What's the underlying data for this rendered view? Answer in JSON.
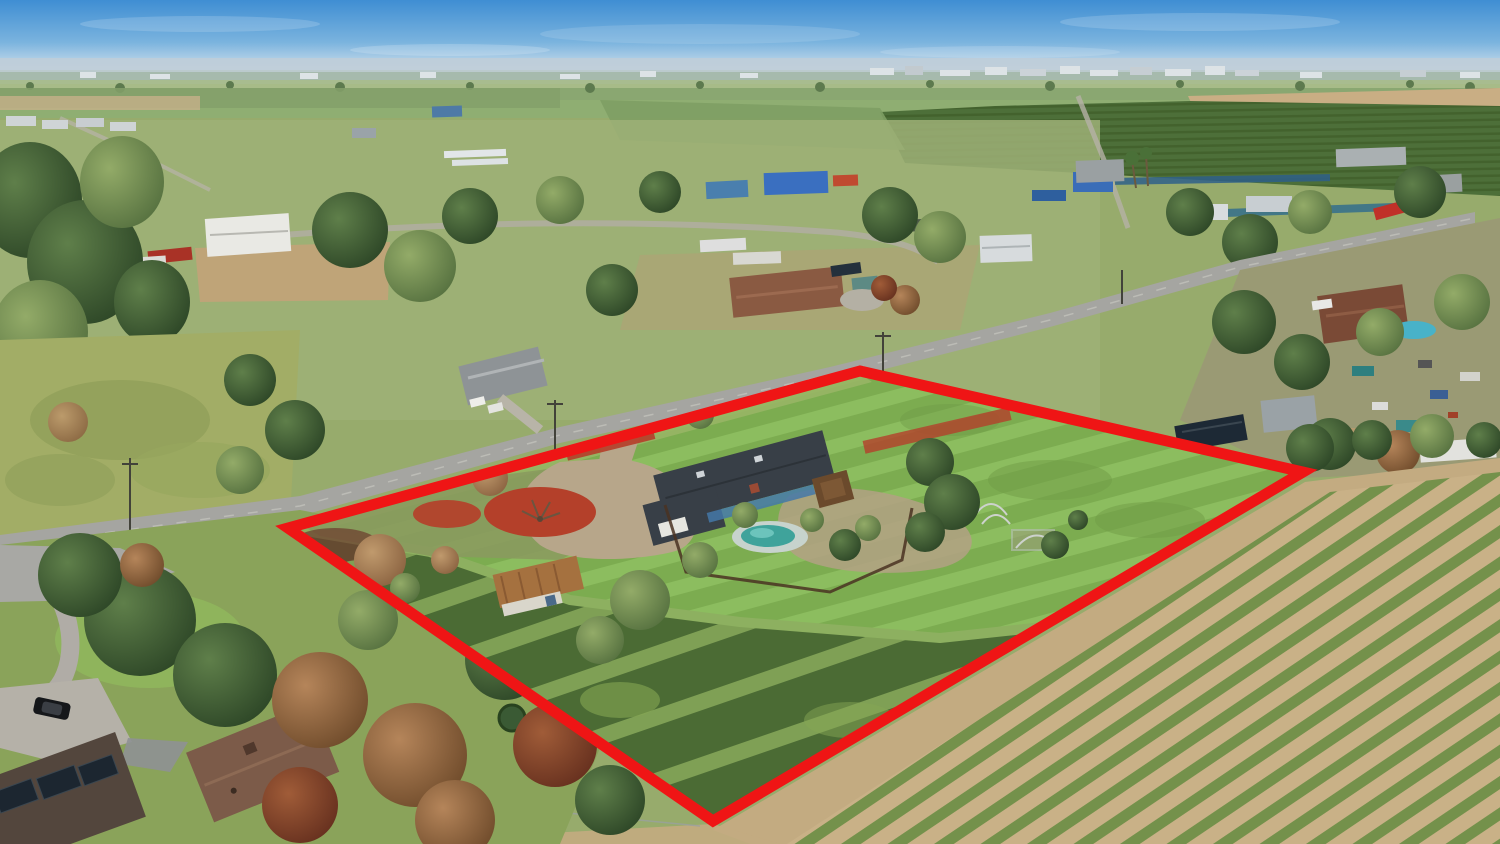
{
  "image": {
    "kind": "aerial-drone-photograph",
    "description": "Aerial view of a rural residential parcel outlined in red, with a ranch house, pool, shed, large mowed lawn and overgrown rows, surrounded by country homes, a road, orchards, a distant town and a fallow row-crop field",
    "width_px": 1500,
    "height_px": 844
  },
  "boundary": {
    "label": "property-boundary-outline",
    "points": "860,371 1303,472 713,821 288,528",
    "color": "#ef1515",
    "stroke_width": 11
  },
  "palette": {
    "sky_top": "#3f8ed3",
    "sky_horizon": "#cfdfeb",
    "haze": "#bfcdd8",
    "ground_base": "#97ab6c",
    "distant_field": "#a9bd8c",
    "orchard_green": "#4d6f39",
    "orchard_row": "#43622d",
    "valley_tan": "#c9ae84",
    "crop_soil": "#c9b187",
    "crop_green": "#74914b",
    "lawn_green": "#7cac50",
    "lawn_light": "#8cbd5f",
    "overgrown_light": "#7fa055",
    "overgrown_dark": "#4b6b34",
    "road_gray": "#a5a5a1",
    "dirt_road": "#c3ab81",
    "mulch_red": "#b4402a",
    "roof_charcoal": "#383f47",
    "wall_blue": "#4478a8",
    "roof_brown": "#7c5b49",
    "corner_roof": "#53463d",
    "shed_rust": "#a5713f",
    "pool_teal": "#3fa39b",
    "pool_deck": "#c7d3cd",
    "solar_dark": "#1d2935"
  },
  "features": {
    "sky": "clear blue sky hazy at horizon",
    "distant": "valley floor with distant white farm and town buildings",
    "orchard": "dark green orchard block with planted rows",
    "crop_field": "fallow field with diagonal weed rows on tan soil",
    "subject_lawn": "large mowed green lawn with mowing stripes",
    "main_house": "single-story ranch home, dark shingle roof, blue walls, white garage",
    "gazebo": "brown-roof gazebo beside the house",
    "pool": "backyard swimming pool",
    "shed": "weathered outbuilding with rusted metal roof",
    "mulch": "circular red mulch tree ring and red mulch beds",
    "road": "two-lane country road running diagonally past the parcel",
    "neighborhood": "scattered rural homes, barns, trailers and trees"
  }
}
